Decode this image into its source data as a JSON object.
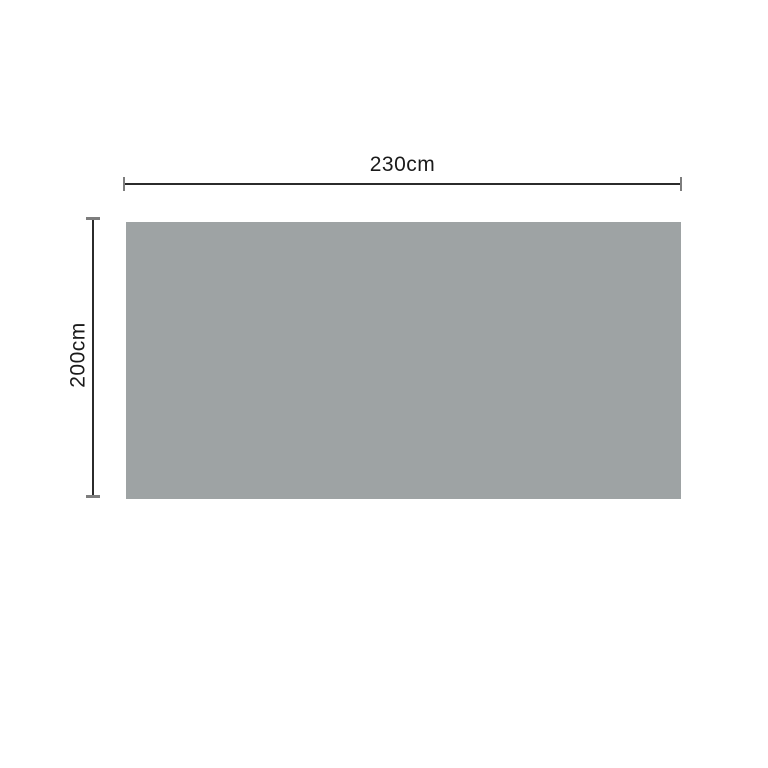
{
  "diagram": {
    "width_dimension": {
      "label": "230cm"
    },
    "height_dimension": {
      "label": "200cm"
    },
    "colors": {
      "panel": "#9ea3a4",
      "dimension_line": "#2b2b2b",
      "dimension_tick": "#7d7d7d",
      "label_text": "#1a1a1a",
      "background": "#ffffff"
    }
  }
}
